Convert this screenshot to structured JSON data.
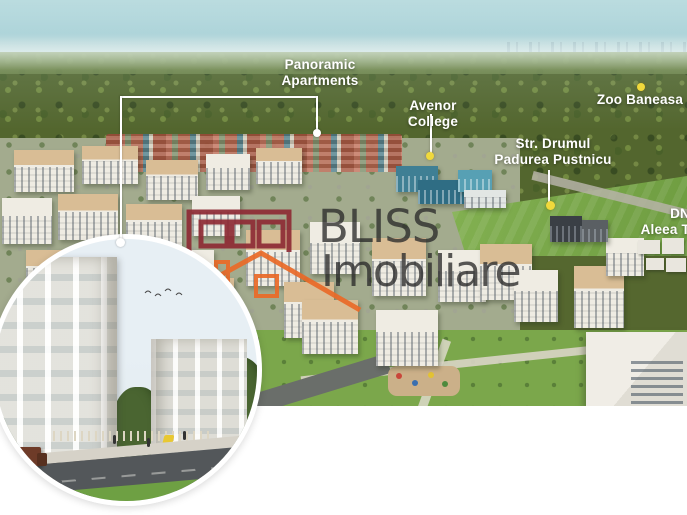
{
  "brand": {
    "name_line1": "BLISS",
    "name_line2": "Imobiliare"
  },
  "annotations": {
    "panoramic": {
      "line1": "Panoramic",
      "line2": "Apartments"
    },
    "avenor": {
      "label": "Avenor College"
    },
    "zoo": {
      "label": "Zoo Baneasa"
    },
    "street": {
      "line1": "Str. Drumul",
      "line2": "Padurea Pustnicu"
    },
    "road_dn": {
      "label": "DN"
    },
    "road_aleea": {
      "label": "Aleea T"
    }
  },
  "colors": {
    "marker_yellow": "#f0d93c",
    "leader_white": "#ffffff",
    "label_text": "#ffffff",
    "logo_red": "#8e2b35",
    "logo_orange": "#ea6a28",
    "watermark_text": "#2a2a2a"
  }
}
